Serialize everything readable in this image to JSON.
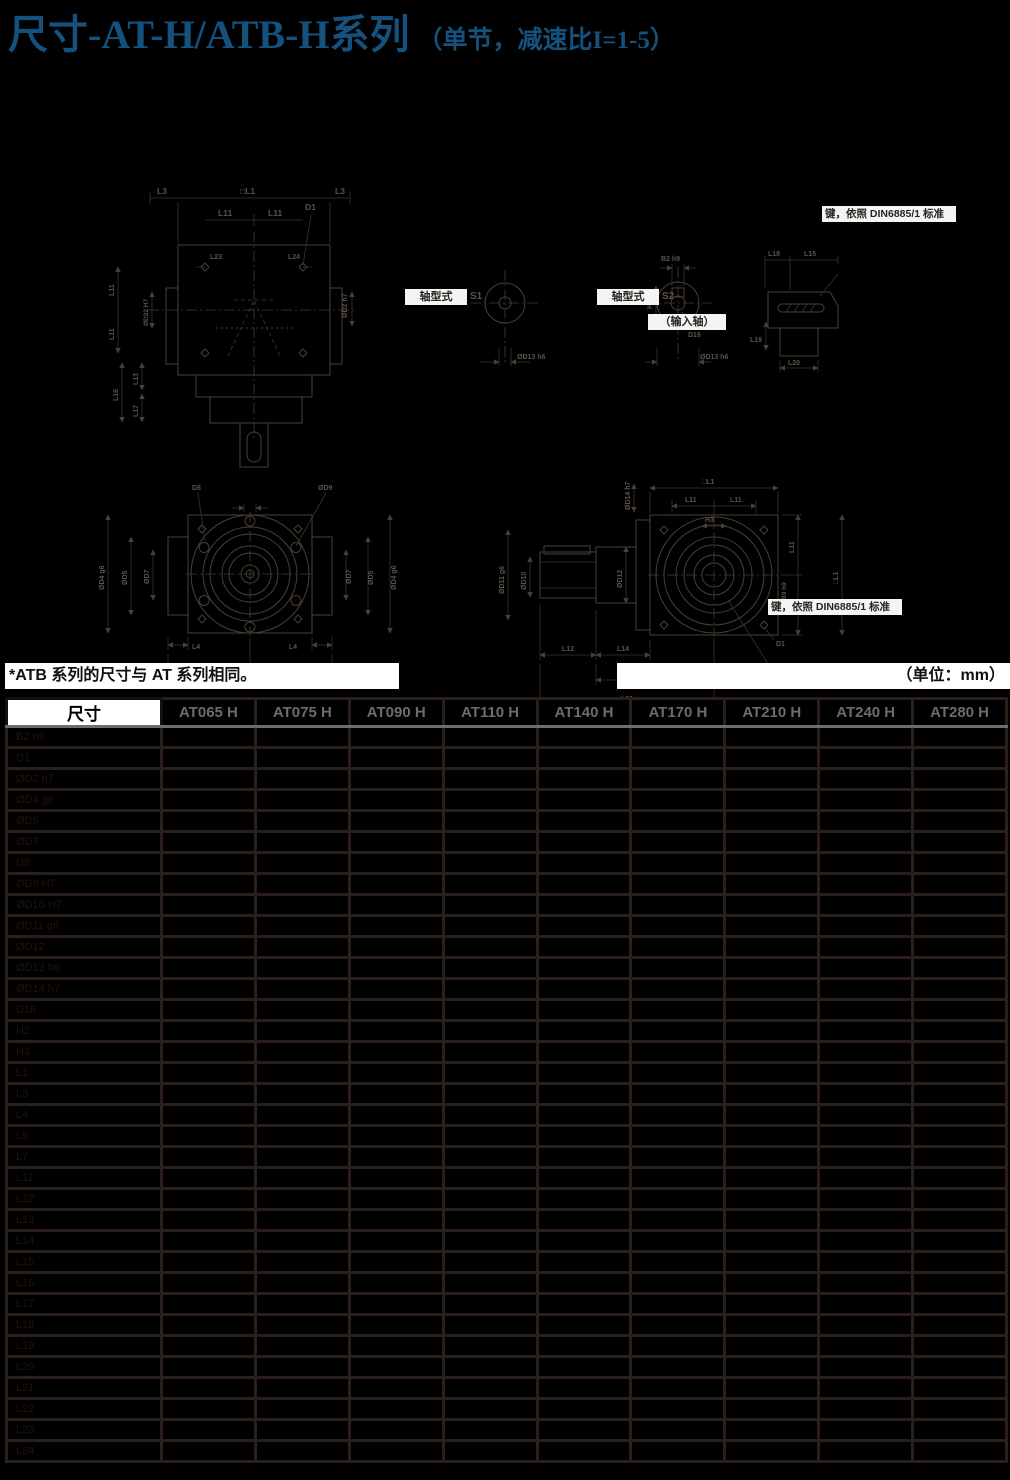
{
  "title": {
    "main": "尺寸-AT-H/ATB-H系列",
    "sub": "（单节，减速比I=1-5）"
  },
  "notes": {
    "left": "*ATB 系列的尺寸与 AT 系列相同。",
    "right": "（单位：mm）"
  },
  "drawings": {
    "v1": {
      "l3_left": "L3",
      "l1": "□L1",
      "l3_right": "L3",
      "l11_top_left": "L11",
      "l11_top_right": "L11",
      "d1": "D1",
      "l23": "L23",
      "l24": "L24",
      "d2": "ØD2 h7",
      "l11_left_upper": "L11",
      "l11_left_lower": "L11",
      "d22": "ØD22 H7",
      "l13": "L13",
      "l16": "L16",
      "l17": "L17"
    },
    "v2": {
      "type_box": "轴型式",
      "variant": "S1",
      "d13": "ØD13 h6"
    },
    "v3": {
      "type_box": "轴型式",
      "variant": "S2",
      "b2": "B2 h9",
      "h2": "H2",
      "d16": "D16",
      "d13": "ØD13 h6",
      "caption": "（输入轴）"
    },
    "v4": {
      "l18": "L18",
      "l15": "L15",
      "l19": "L19",
      "l20": "L20",
      "key_note": "键，依照 DIN6885/1 标准"
    },
    "v5": {
      "d8": "D8",
      "d9": "ØD9",
      "d4_left": "ØD4 g6",
      "d5_left": "ØD5",
      "d7_left": "ØD7",
      "d7_right": "ØD7",
      "d5_right": "ØD5",
      "d4_right": "ØD4 g6",
      "l4_left": "L4",
      "l4_right": "L4",
      "l7_left": "L7",
      "l7_right": "L7"
    },
    "v6": {
      "l1_top": "□L1",
      "l11_top_left": "L11",
      "l11_top_right": "L11",
      "h3": "H3",
      "d14": "ØD14 h7",
      "d12": "ØD12",
      "d11": "ØD11 g6",
      "d10": "ØD10",
      "l11_right_upper": "L11",
      "l11_right_lower": "L11",
      "l1_right": "□L1",
      "b9": "B9 h9",
      "l12": "L12",
      "l14": "L14",
      "l21": "L21",
      "l22": "L22",
      "d1": "D1",
      "key_note": "键，依照 DIN6885/1 标准"
    }
  },
  "table": {
    "corner": "尺寸",
    "columns": [
      "AT065 H",
      "AT075 H",
      "AT090 H",
      "AT110 H",
      "AT140 H",
      "AT170 H",
      "AT210 H",
      "AT240 H",
      "AT280 H"
    ],
    "rows": [
      {
        "label": "B2 h9",
        "values": [
          "",
          "",
          "",
          "",
          "",
          "",
          "",
          "",
          ""
        ]
      },
      {
        "label": "D1",
        "values": [
          "",
          "",
          "",
          "",
          "",
          "",
          "",
          "",
          ""
        ]
      },
      {
        "label": "ØD2 h7",
        "values": [
          "",
          "",
          "",
          "",
          "",
          "",
          "",
          "",
          ""
        ]
      },
      {
        "label": "ØD4 g6",
        "values": [
          "",
          "",
          "",
          "",
          "",
          "",
          "",
          "",
          ""
        ]
      },
      {
        "label": "ØD5",
        "values": [
          "",
          "",
          "",
          "",
          "",
          "",
          "",
          "",
          ""
        ]
      },
      {
        "label": "ØD7",
        "values": [
          "",
          "",
          "",
          "",
          "",
          "",
          "",
          "",
          ""
        ]
      },
      {
        "label": "D8",
        "values": [
          "",
          "",
          "",
          "",
          "",
          "",
          "",
          "",
          ""
        ]
      },
      {
        "label": "ØD9 H7",
        "values": [
          "",
          "",
          "",
          "",
          "",
          "",
          "",
          "",
          ""
        ]
      },
      {
        "label": "ØD10 H7",
        "values": [
          "",
          "",
          "",
          "",
          "",
          "",
          "",
          "",
          ""
        ]
      },
      {
        "label": "ØD11 g6",
        "values": [
          "",
          "",
          "",
          "",
          "",
          "",
          "",
          "",
          ""
        ]
      },
      {
        "label": "ØD12",
        "values": [
          "",
          "",
          "",
          "",
          "",
          "",
          "",
          "",
          ""
        ]
      },
      {
        "label": "ØD13 h6",
        "values": [
          "",
          "",
          "",
          "",
          "",
          "",
          "",
          "",
          ""
        ]
      },
      {
        "label": "ØD14 h7",
        "values": [
          "",
          "",
          "",
          "",
          "",
          "",
          "",
          "",
          ""
        ]
      },
      {
        "label": "D16",
        "values": [
          "",
          "",
          "",
          "",
          "",
          "",
          "",
          "",
          ""
        ]
      },
      {
        "label": "H2",
        "values": [
          "",
          "",
          "",
          "",
          "",
          "",
          "",
          "",
          ""
        ]
      },
      {
        "label": "H3",
        "values": [
          "",
          "",
          "",
          "",
          "",
          "",
          "",
          "",
          ""
        ]
      },
      {
        "label": "L1",
        "values": [
          "",
          "",
          "",
          "",
          "",
          "",
          "",
          "",
          ""
        ]
      },
      {
        "label": "L3",
        "values": [
          "",
          "",
          "",
          "",
          "",
          "",
          "",
          "",
          ""
        ]
      },
      {
        "label": "L4",
        "values": [
          "",
          "",
          "",
          "",
          "",
          "",
          "",
          "",
          ""
        ]
      },
      {
        "label": "L5",
        "values": [
          "",
          "",
          "",
          "",
          "",
          "",
          "",
          "",
          ""
        ]
      },
      {
        "label": "L7",
        "values": [
          "",
          "",
          "",
          "",
          "",
          "",
          "",
          "",
          ""
        ]
      },
      {
        "label": "L11",
        "values": [
          "",
          "",
          "",
          "",
          "",
          "",
          "",
          "",
          ""
        ]
      },
      {
        "label": "L12",
        "values": [
          "",
          "",
          "",
          "",
          "",
          "",
          "",
          "",
          ""
        ]
      },
      {
        "label": "L13",
        "values": [
          "",
          "",
          "",
          "",
          "",
          "",
          "",
          "",
          ""
        ]
      },
      {
        "label": "L14",
        "values": [
          "",
          "",
          "",
          "",
          "",
          "",
          "",
          "",
          ""
        ]
      },
      {
        "label": "L15",
        "values": [
          "",
          "",
          "",
          "",
          "",
          "",
          "",
          "",
          ""
        ]
      },
      {
        "label": "L16",
        "values": [
          "",
          "",
          "",
          "",
          "",
          "",
          "",
          "",
          ""
        ]
      },
      {
        "label": "L17",
        "values": [
          "",
          "",
          "",
          "",
          "",
          "",
          "",
          "",
          ""
        ]
      },
      {
        "label": "L18",
        "values": [
          "",
          "",
          "",
          "",
          "",
          "",
          "",
          "",
          ""
        ]
      },
      {
        "label": "L19",
        "values": [
          "",
          "",
          "",
          "",
          "",
          "",
          "",
          "",
          ""
        ]
      },
      {
        "label": "L20",
        "values": [
          "",
          "",
          "",
          "",
          "",
          "",
          "",
          "",
          ""
        ]
      },
      {
        "label": "L21",
        "values": [
          "",
          "",
          "",
          "",
          "",
          "",
          "",
          "",
          ""
        ]
      },
      {
        "label": "L22",
        "values": [
          "",
          "",
          "",
          "",
          "",
          "",
          "",
          "",
          ""
        ]
      },
      {
        "label": "L23",
        "values": [
          "",
          "",
          "",
          "",
          "",
          "",
          "",
          "",
          ""
        ]
      },
      {
        "label": "L24",
        "values": [
          "",
          "",
          "",
          "",
          "",
          "",
          "",
          "",
          ""
        ]
      }
    ]
  }
}
